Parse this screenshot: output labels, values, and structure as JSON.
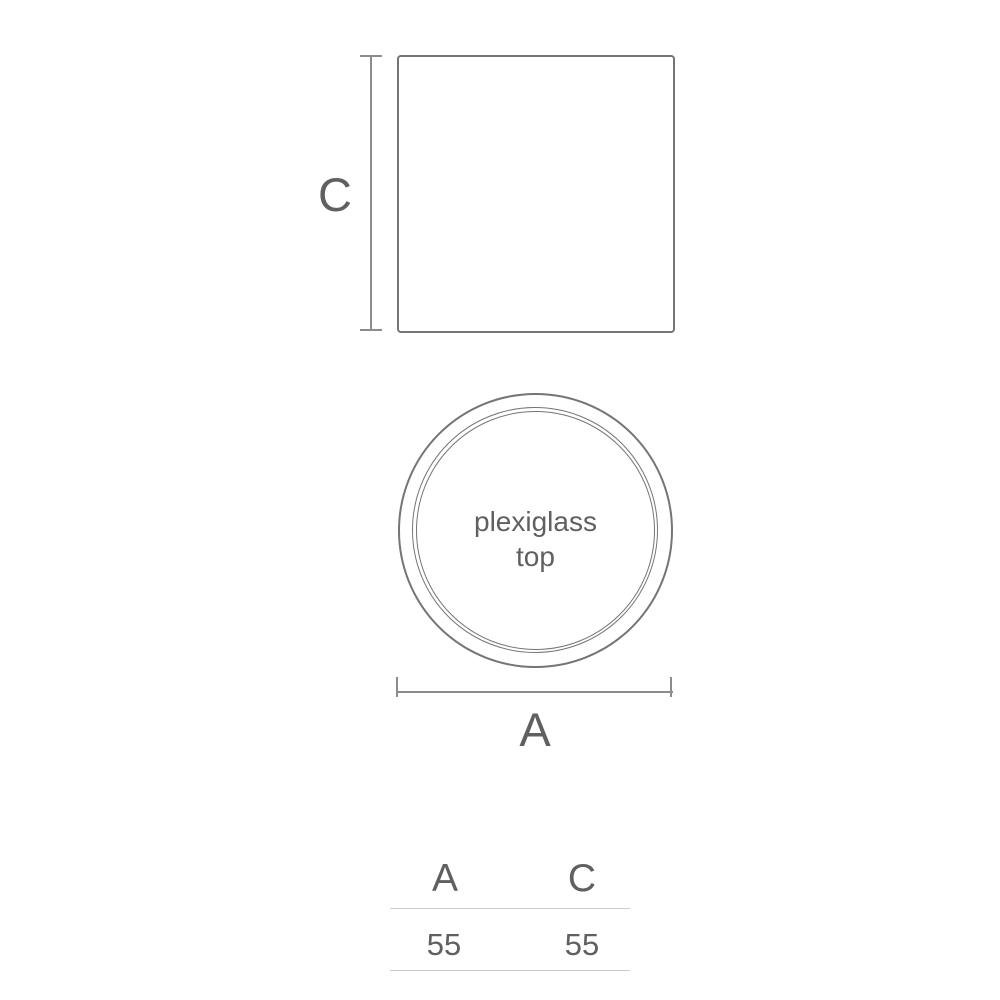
{
  "diagram": {
    "side_view": {
      "dim_label": "C"
    },
    "top_view": {
      "label_line1": "plexiglass",
      "label_line2": "top",
      "dim_label": "A"
    }
  },
  "table": {
    "headers": [
      "A",
      "C"
    ],
    "values": [
      "55",
      "55"
    ]
  },
  "colors": {
    "outline": "#757575",
    "dimension": "#8c8c8c",
    "label_text": "#606060",
    "table_rule": "#cccccc",
    "background": "#ffffff"
  }
}
